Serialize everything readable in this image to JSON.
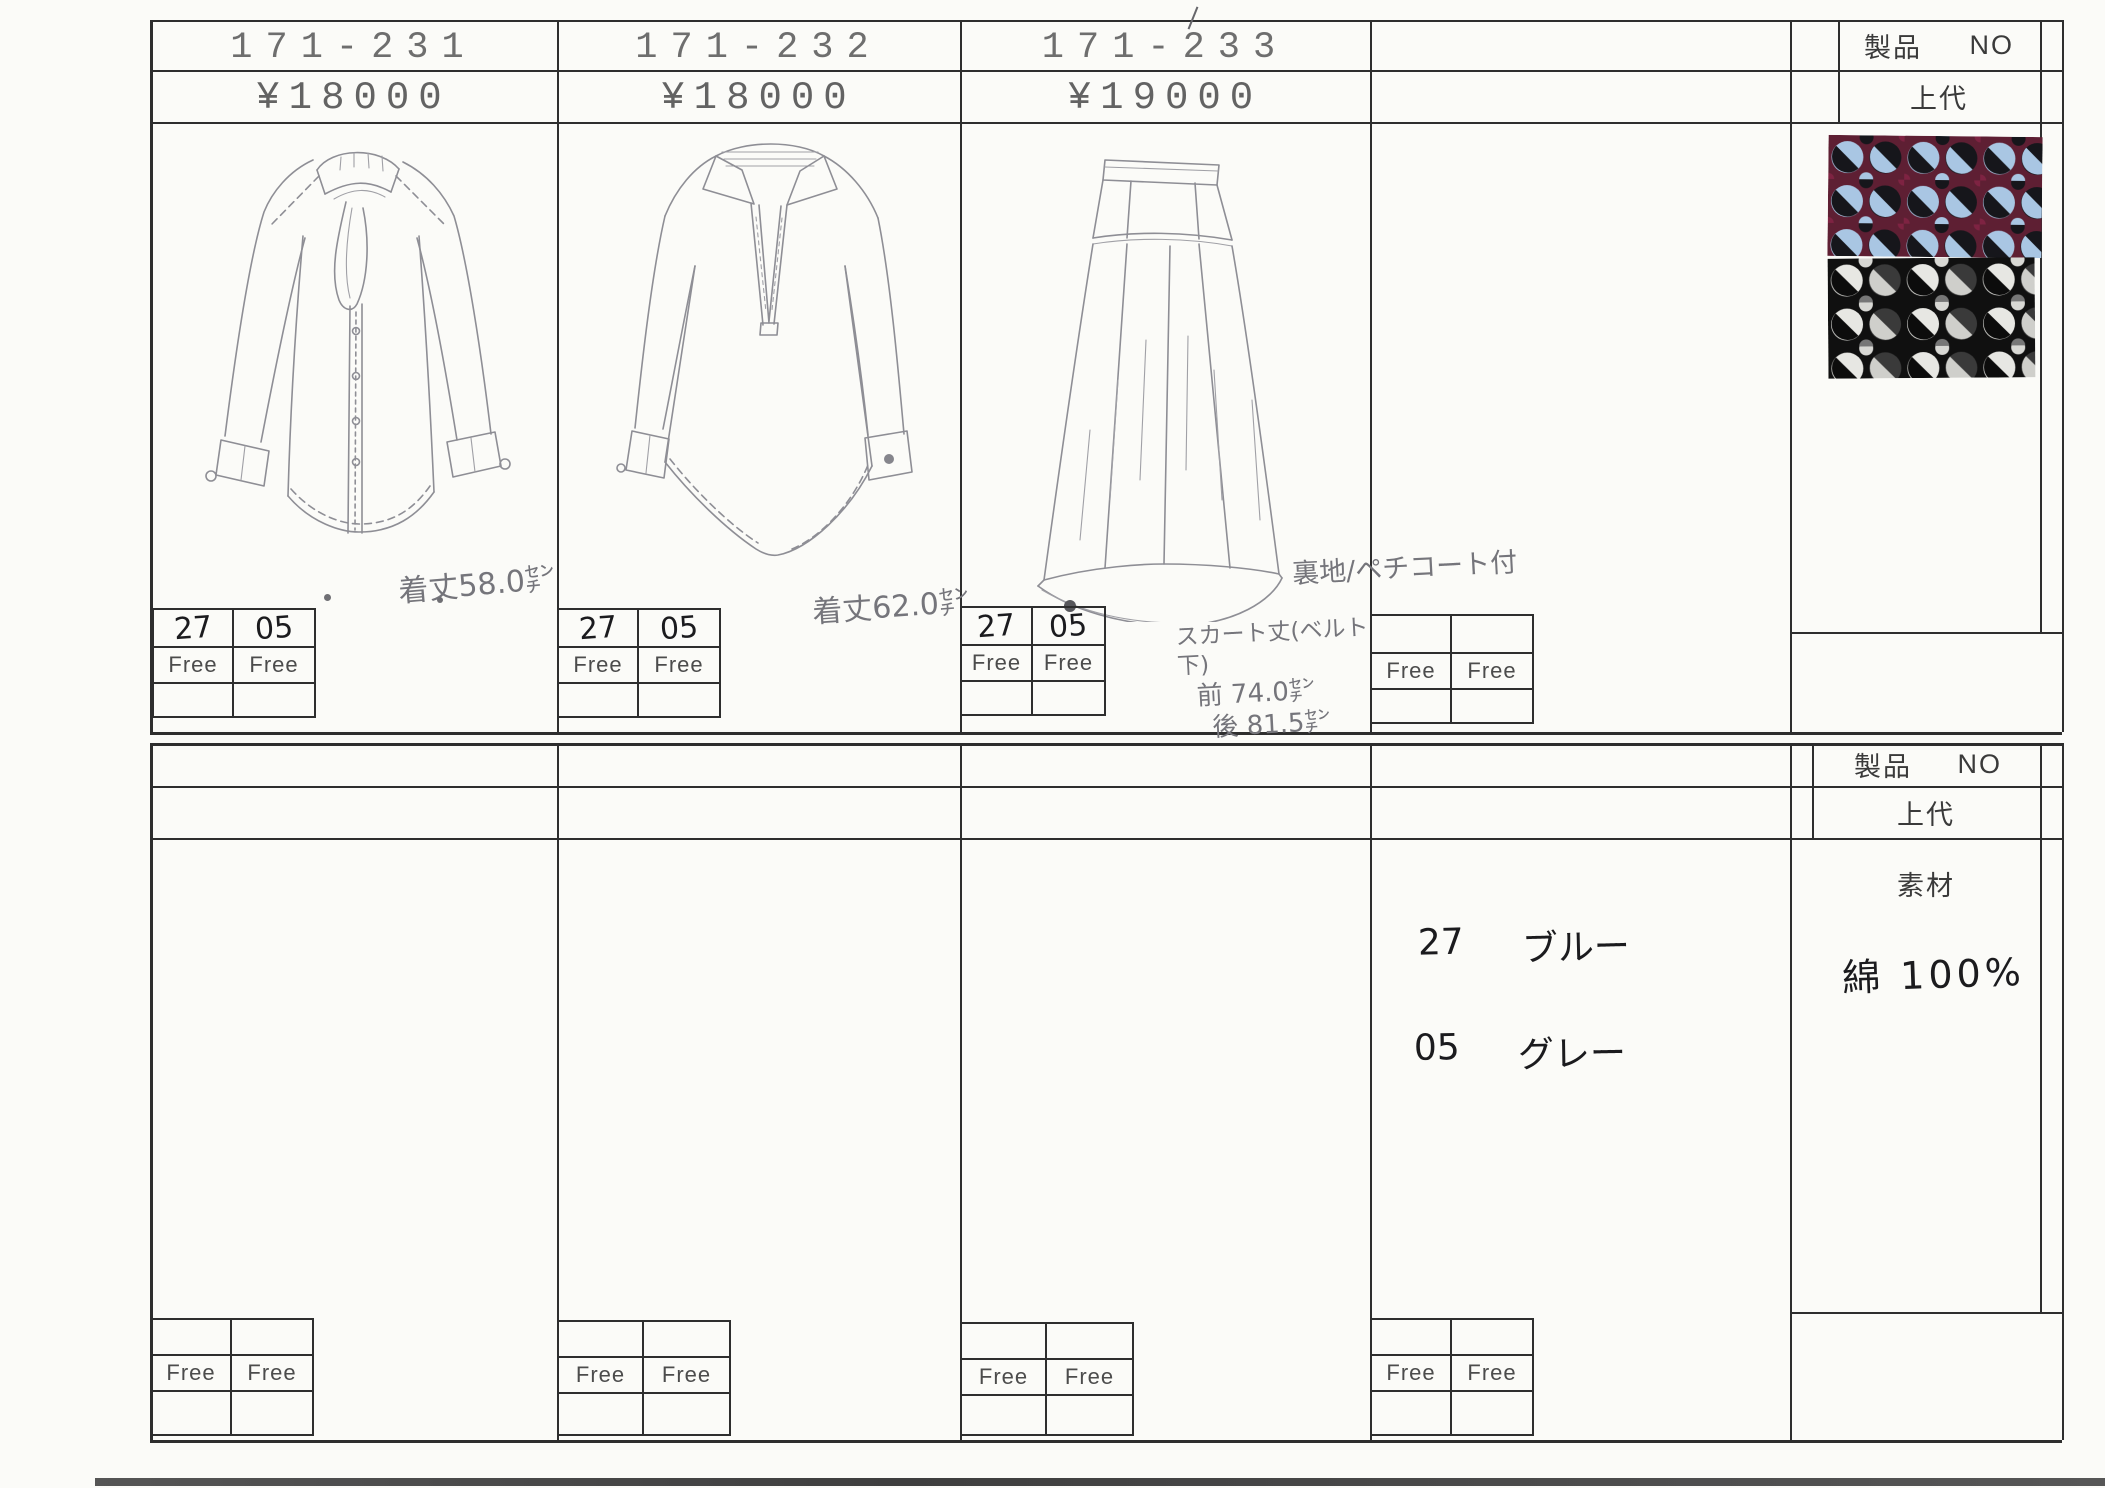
{
  "products": [
    {
      "number": "171-231",
      "price": "¥18000",
      "length_note": "着丈58.0㌢",
      "color_codes": [
        "27",
        "05"
      ],
      "sizes": [
        "Free",
        "Free"
      ]
    },
    {
      "number": "171-232",
      "price": "¥18000",
      "length_note": "着丈62.0㌢",
      "color_codes": [
        "27",
        "05"
      ],
      "sizes": [
        "Free",
        "Free"
      ]
    },
    {
      "number": "171-233",
      "price": "¥19000",
      "lining_note": "裏地/ペチコート付",
      "skirt_length": {
        "title": "スカート丈(ベルト下)",
        "front": "前 74.0㌢",
        "back": "後 81.5㌢"
      },
      "color_codes": [
        "27",
        "05"
      ],
      "sizes": [
        "Free",
        "Free"
      ]
    }
  ],
  "col4": {
    "sizes": [
      "Free",
      "Free"
    ]
  },
  "info_top": {
    "product_label": "製品",
    "no_label": "NO",
    "retail_label": "上代"
  },
  "info_bottom": {
    "product_label": "製品",
    "no_label": "NO",
    "retail_label": "上代",
    "material_label": "素材",
    "material_value": "綿 100%"
  },
  "color_legend": [
    {
      "code": "27",
      "name": "ブルー"
    },
    {
      "code": "05",
      "name": "グレー"
    }
  ],
  "bottom_sizes": {
    "col1": [
      "Free",
      "Free"
    ],
    "col2": [
      "Free",
      "Free"
    ],
    "col3": [
      "Free",
      "Free"
    ],
    "col4": [
      "Free",
      "Free"
    ]
  },
  "fabric_swatches": [
    {
      "name": "circle-jacquard-blue-bordeaux-black",
      "palette": [
        "#a9c6e3",
        "#5e1f33",
        "#16161b"
      ]
    },
    {
      "name": "circle-jacquard-black-white-grey",
      "palette": [
        "#e7e7e3",
        "#111111",
        "#777777"
      ]
    }
  ]
}
